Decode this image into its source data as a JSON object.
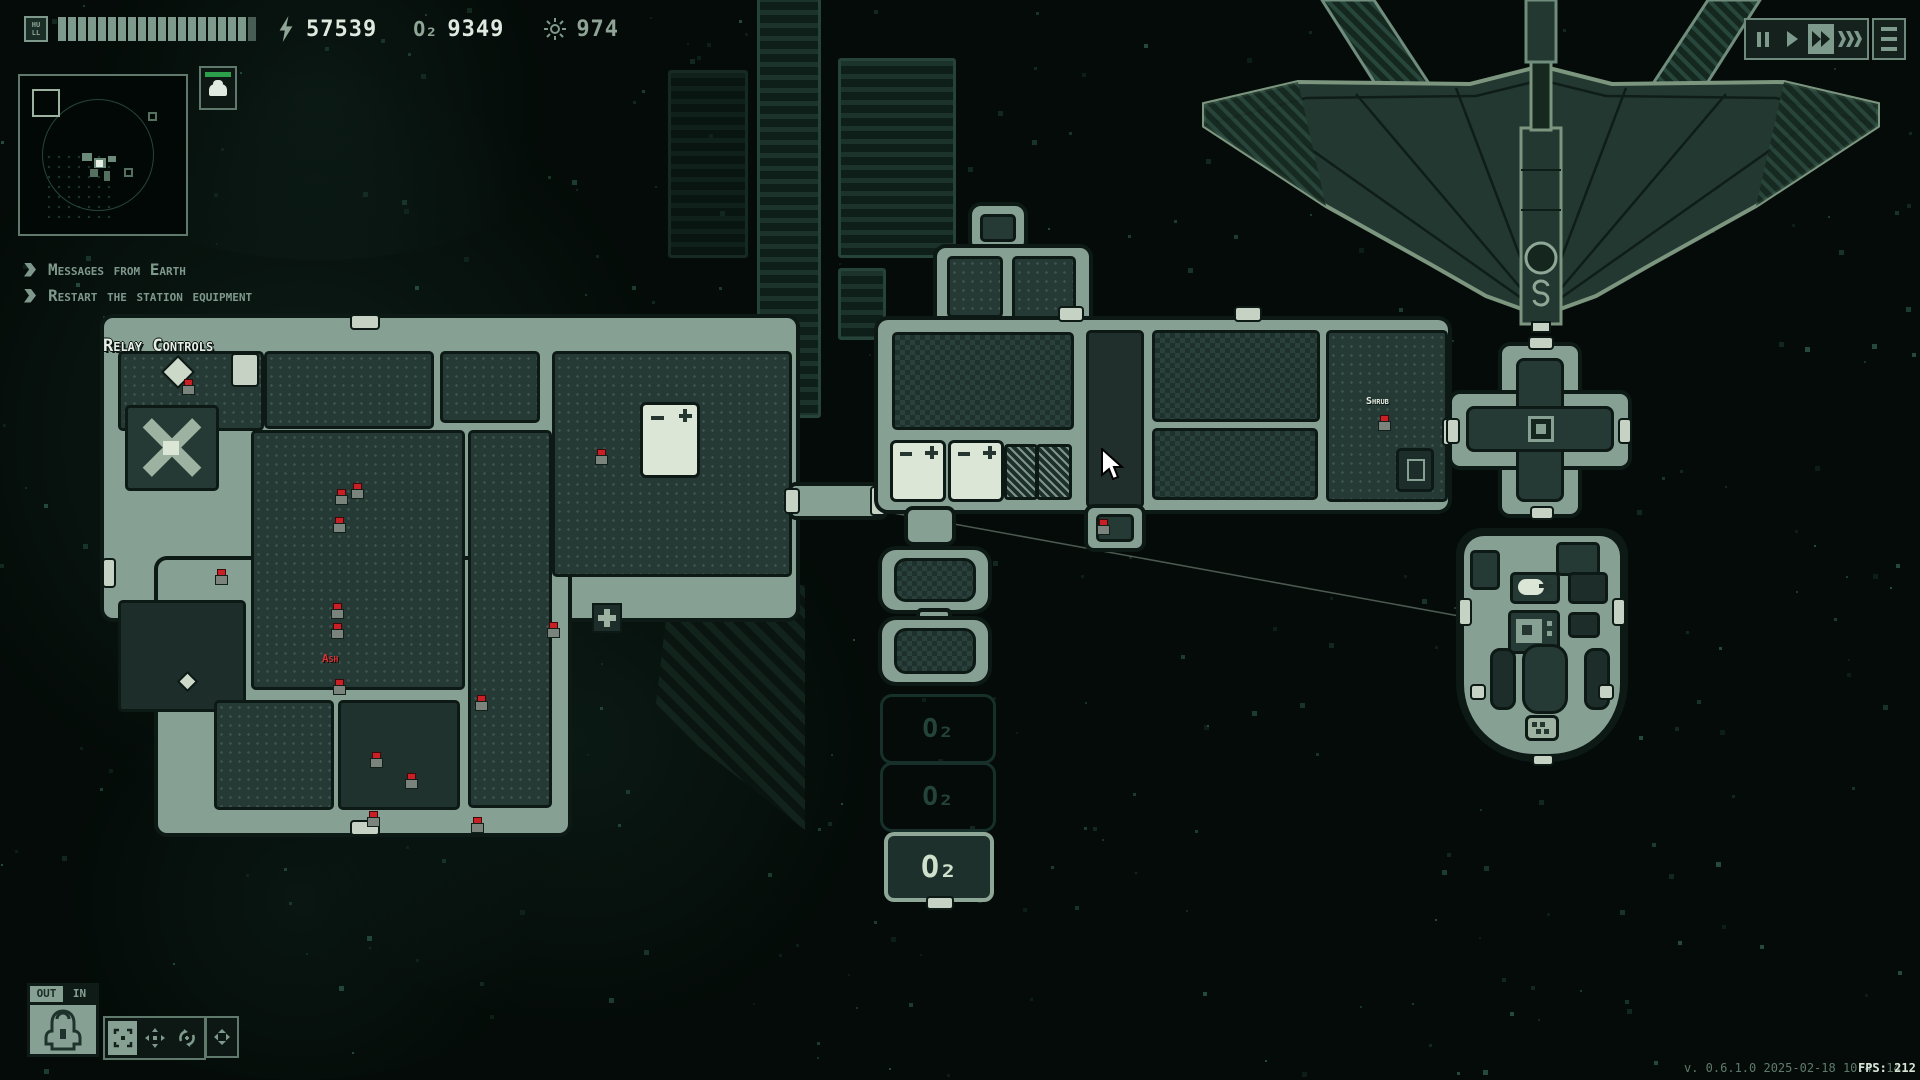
{
  "top_bar": {
    "hull_label": "HULL",
    "hull_segments": 20,
    "power_value": "57539",
    "oxygen_value": "9349",
    "oxygen_icon": "O₂",
    "sun_value": "974"
  },
  "notifications": [
    {
      "label": "Messages from Earth"
    },
    {
      "label": "Restart the station equipment"
    }
  ],
  "map_labels": {
    "relay_room": "Relay Controls",
    "crew_ash": "Ash",
    "crew_shrub": "Shrub",
    "o2": "O₂"
  },
  "playback": {
    "buttons": [
      "pause-icon",
      "play-icon",
      "fast-forward-icon",
      "fastest-icon"
    ],
    "active": "fast-forward"
  },
  "bottom_left": {
    "out_tab": "OUT",
    "in_tab": "IN"
  },
  "status_bar": {
    "version": "v. 0.6.1.0 2025-02-18 10:45:14",
    "fps": "FPS: 212"
  },
  "crew_markers": [
    [
      183,
      380
    ],
    [
      336,
      490
    ],
    [
      352,
      484
    ],
    [
      334,
      518
    ],
    [
      216,
      570
    ],
    [
      332,
      604
    ],
    [
      332,
      624
    ],
    [
      548,
      623
    ],
    [
      596,
      450
    ],
    [
      334,
      680
    ],
    [
      476,
      696
    ],
    [
      371,
      753
    ],
    [
      406,
      774
    ],
    [
      472,
      818
    ],
    [
      368,
      812
    ],
    [
      1379,
      416
    ],
    [
      1098,
      520
    ]
  ],
  "colors": {
    "sage": "#87a094",
    "bright_text": "#dfe9df",
    "dim_text": "#7e998c",
    "alert_red": "#c92026",
    "crew_ok_green": "#2ca04a"
  }
}
